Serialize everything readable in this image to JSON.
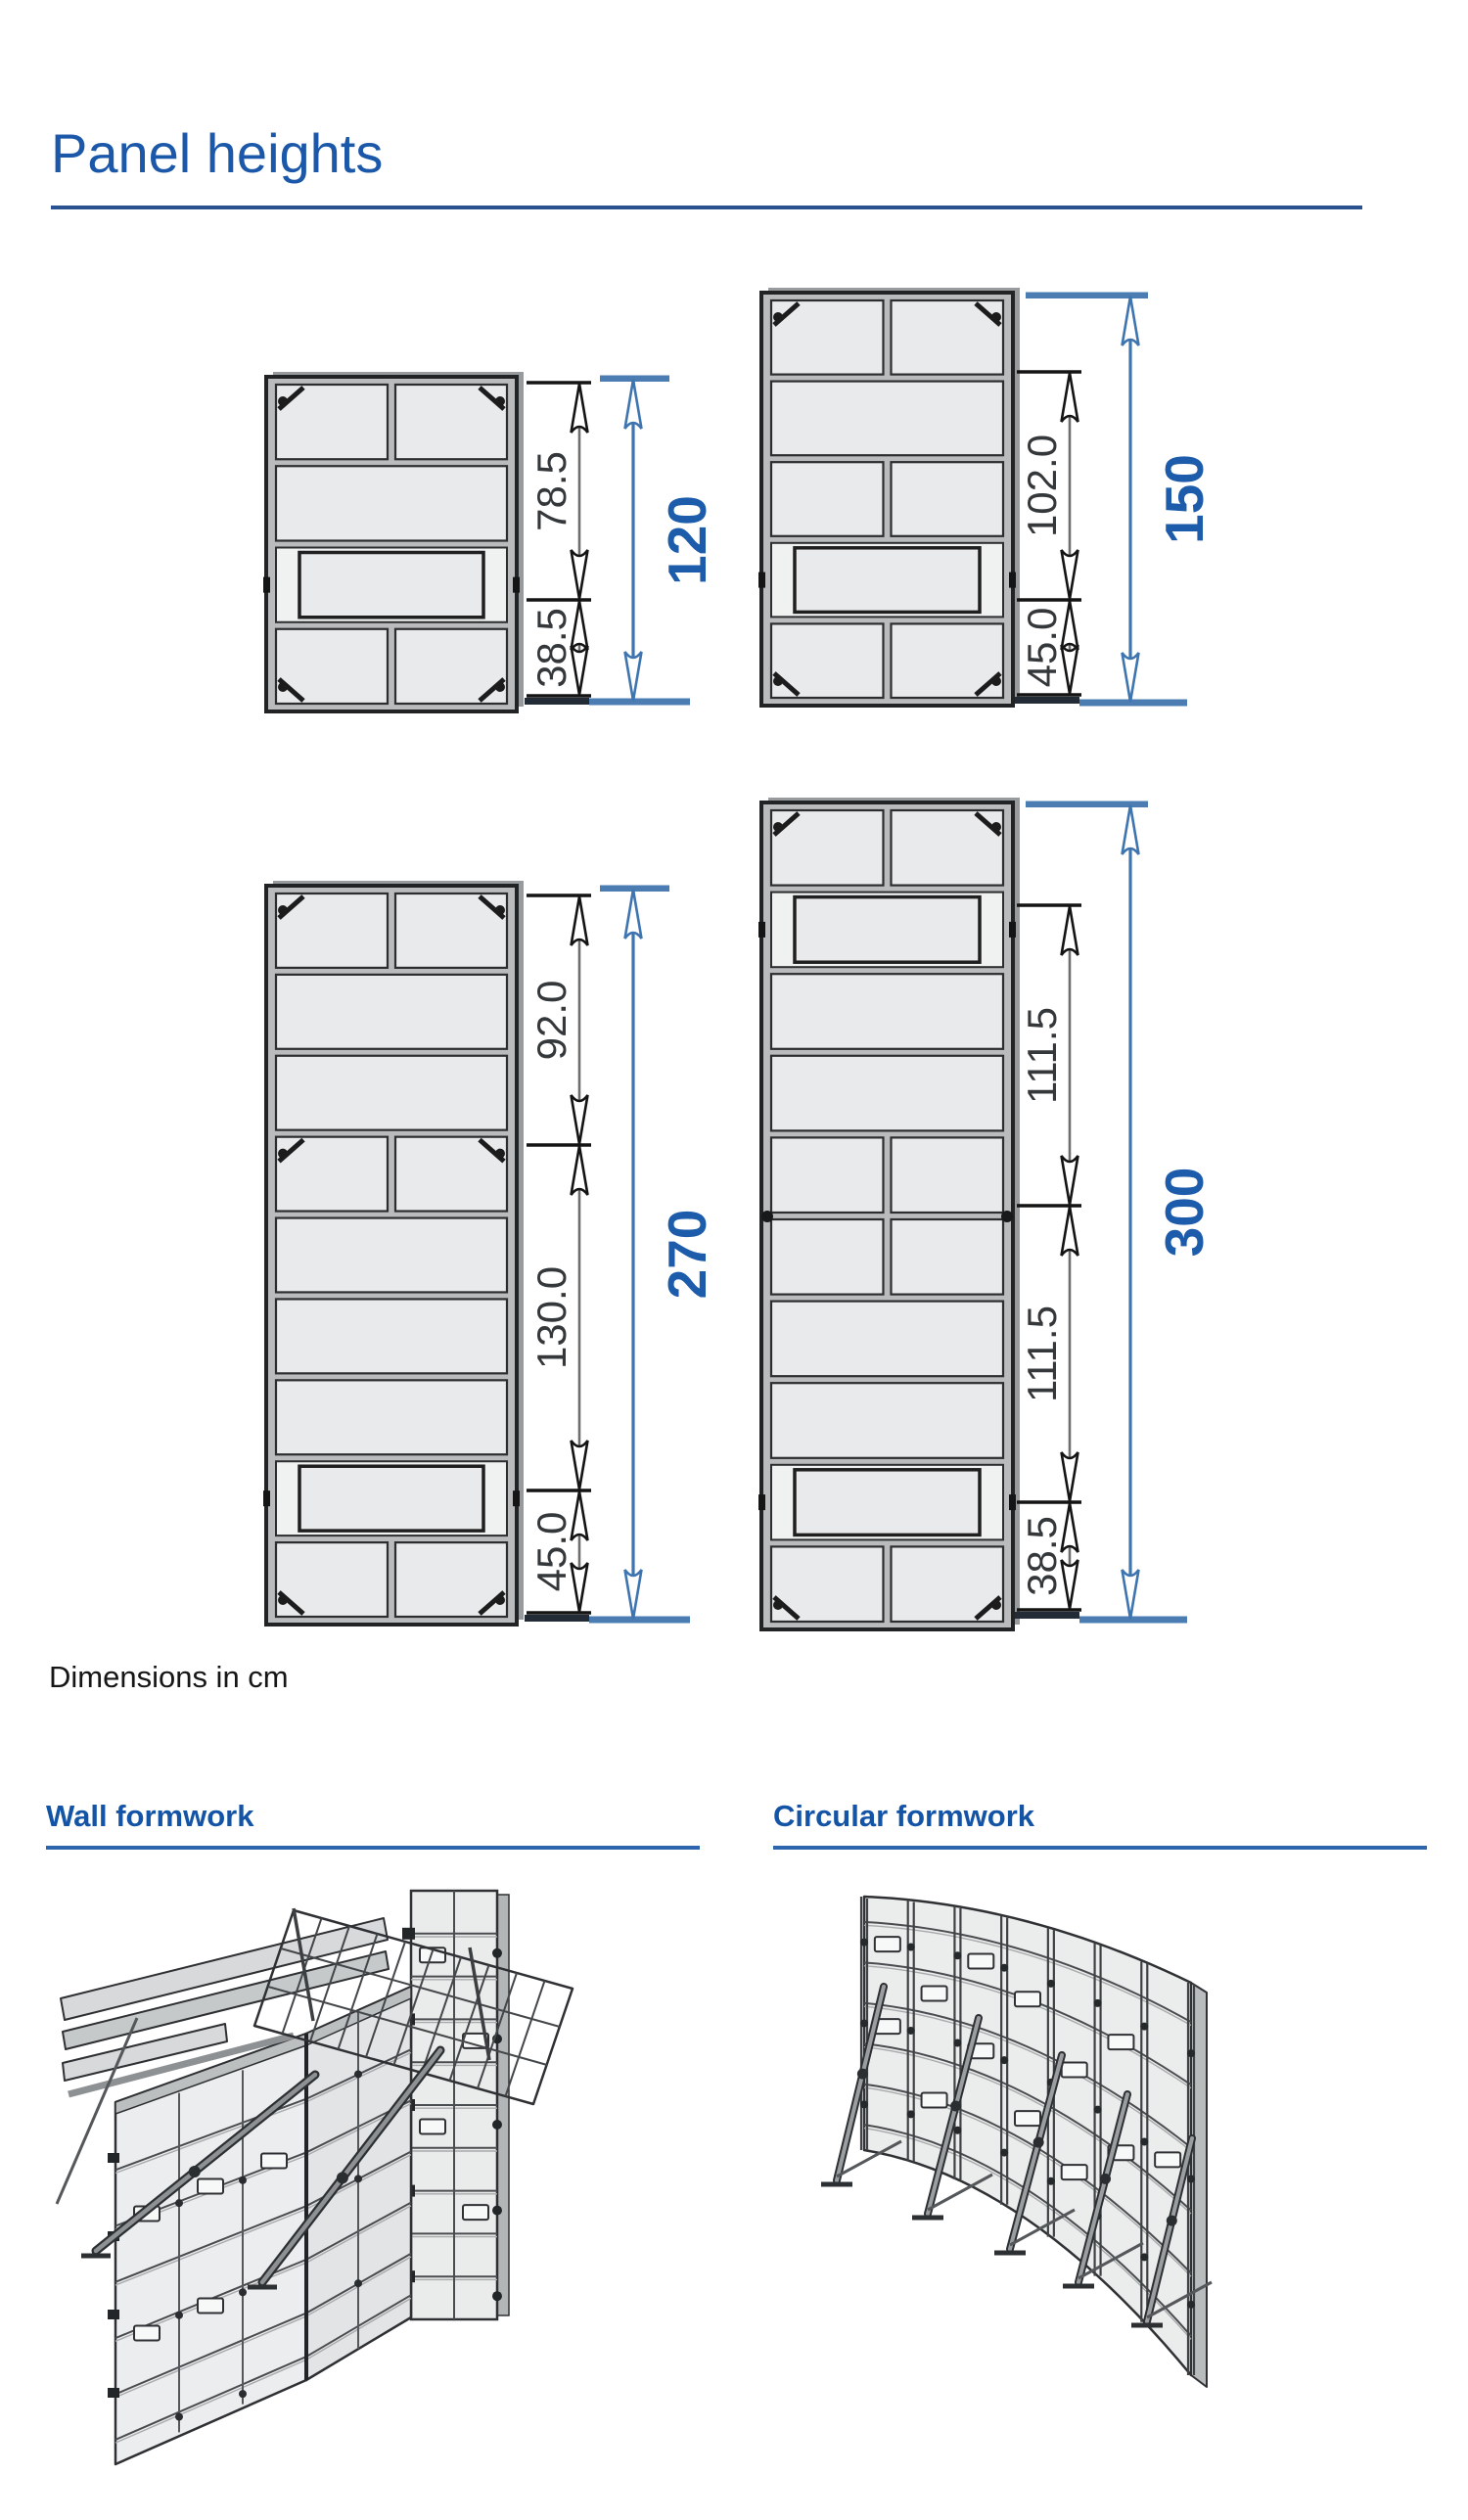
{
  "page": {
    "title": "Panel heights",
    "note": "Dimensions in cm"
  },
  "sections": [
    {
      "title": "Wall formwork"
    },
    {
      "title": "Circular formwork"
    }
  ],
  "colors": {
    "heading_blue": "#1c58a9",
    "section_blue": "#1454a6",
    "overall_dim_blue": "#1d5cab",
    "dim_line_blue": "#3e74b0",
    "segment_dim_dark": "#35383b"
  },
  "diagram": {
    "unit": "cm",
    "panels": [
      {
        "name": "panel-height-120",
        "total": "120",
        "segments": [
          "78.5",
          "38.5"
        ]
      },
      {
        "name": "panel-height-150",
        "total": "150",
        "segments": [
          "102.0",
          "45.0"
        ]
      },
      {
        "name": "panel-height-270",
        "total": "270",
        "segments": [
          "92.0",
          "130.0",
          "45.0"
        ]
      },
      {
        "name": "panel-height-300",
        "total": "300",
        "segments": [
          "111.5",
          "111.5",
          "38.5"
        ]
      }
    ]
  }
}
